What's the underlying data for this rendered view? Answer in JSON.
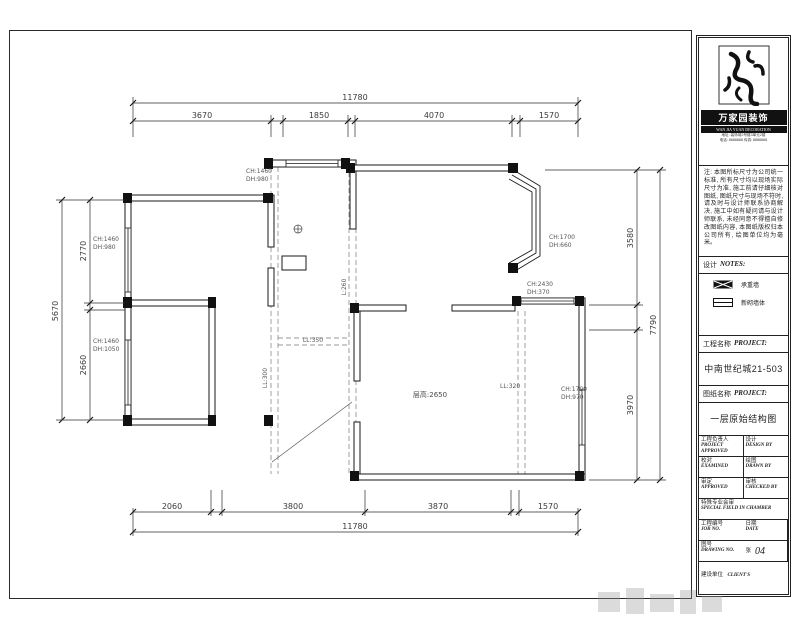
{
  "plan": {
    "dims": {
      "top_overall": "11780",
      "top": [
        "3670",
        "1850",
        "4070",
        "1570"
      ],
      "bottom": [
        "2060",
        "3800",
        "3870",
        "1570"
      ],
      "bottom_overall": "11780",
      "left": [
        "2770",
        "2660"
      ],
      "left_overall": "5670",
      "right": [
        "3580",
        "3970"
      ],
      "right_overall": "7790"
    },
    "annotations": {
      "win_left_top_ch": "CH:1460",
      "win_left_top_dh": "DH:980",
      "win_left_bottom_ch": "CH:1460",
      "win_left_bottom_dh": "DH:1050",
      "win_top_ch": "CH:1460",
      "win_top_dh": "DH:980",
      "win_bay_ch": "CH:1700",
      "win_bay_dh": "DH:660",
      "win_right_mid_ch": "CH:2430",
      "win_right_mid_dh": "DH:370",
      "win_right_low_ch": "CH:1790",
      "win_right_low_dh": "DH:970",
      "beam_h": "LL:350",
      "beam_v_left": "LL:300",
      "beam_v_mid": "L:260",
      "beam_right": "LL:320",
      "ceiling_height": "层高:2650"
    }
  },
  "titleblock": {
    "brand": "万家园装饰",
    "brand_en": "WAN JIA YUAN DECORATION",
    "addr1": "地址: 装饰城2号楼3单元2楼",
    "addr2": "电话: 8888888  传真: 8888888",
    "notes_body": "注: 本图所标尺寸为公司统一标准, 所有尺寸均以现场实际尺寸为准, 施工前请仔细核对图纸, 图纸尺寸与现场不符时, 请及时与设计师联系协商解决, 施工中如有疑问请与设计师联系, 未经同意不得擅自修改图纸内容, 本图纸版权归本公司所有, 绘图单位均为毫米。",
    "notes_cn": "设计",
    "notes_en": "NOTES:",
    "legend": [
      {
        "label": "承重墙"
      },
      {
        "label": "新砌墙体"
      }
    ],
    "project_cn": "工程名称",
    "project_en": "PROJECT:",
    "project_value": "中南世纪城21-503",
    "drawing_cn": "图纸名称",
    "drawing_en": "PROJECT:",
    "drawing_value": "一层原始结构图",
    "fields": [
      {
        "cn": "工程负责人",
        "en": "PROJECT APPROVED"
      },
      {
        "cn": "设计",
        "en": "DESIGN BY"
      },
      {
        "cn": "校对",
        "en": "EXAMINED"
      },
      {
        "cn": "绘图",
        "en": "DRAWN BY"
      },
      {
        "cn": "审定",
        "en": "APPROVED"
      },
      {
        "cn": "审核",
        "en": "CHECKED BY"
      },
      {
        "cn": "特殊专业会审",
        "en": "SPECIAL FIELD IN CHAMBER"
      },
      {
        "cn": "工程编号",
        "en": "JOB NO."
      },
      {
        "cn": "日期",
        "en": "DATE"
      },
      {
        "cn": "图号",
        "en": "DRAWING NO."
      },
      {
        "cn": "张",
        "en": ""
      }
    ],
    "sheet_no": "04",
    "client_cn": "建设单位",
    "client_en": "CLIENT'S"
  }
}
